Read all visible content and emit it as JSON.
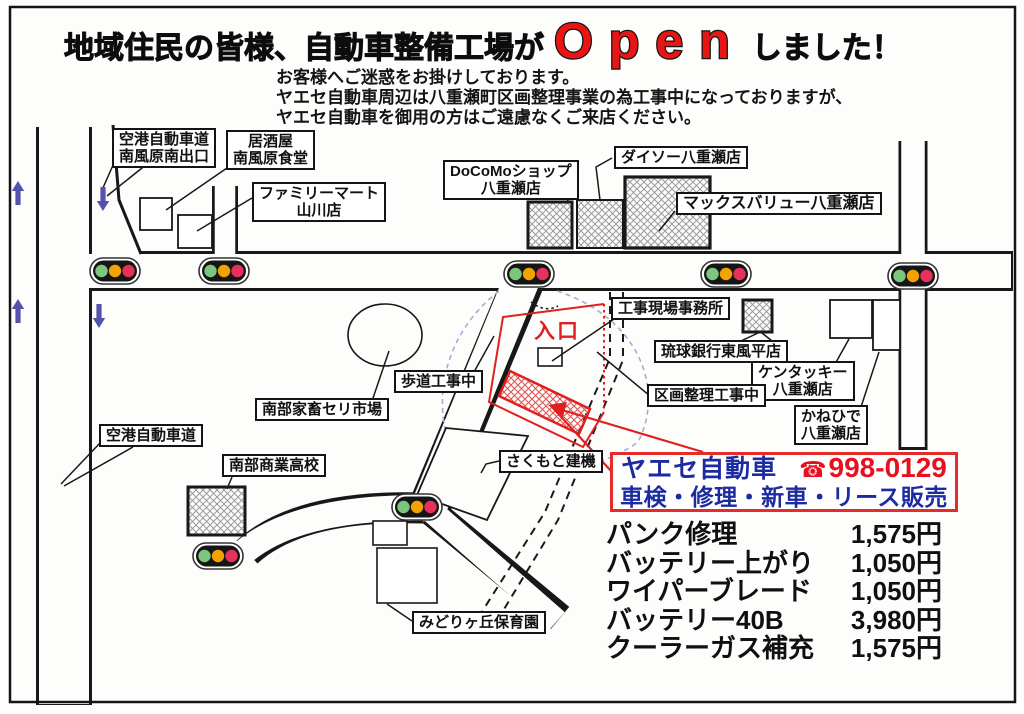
{
  "title": {
    "prefix": "地域住民の皆様、自動車整備工場が",
    "open_word": "Open",
    "suffix": "しました！"
  },
  "notice": "お客様へご迷惑をお掛けしております。\nヤエセ自動車周辺は八重瀬町区画整理事業の為工事中になっておりますが、\nヤエセ自動車を御用の方はご遠慮なくご来店ください。",
  "map": {
    "entrance_label": "入口",
    "labels": [
      {
        "id": "airport-exit",
        "text": "空港自動車道\n南風原南出口"
      },
      {
        "id": "izakaya",
        "text": "居酒屋\n南風原食堂"
      },
      {
        "id": "familymart",
        "text": "ファミリーマート\n山川店"
      },
      {
        "id": "docomo",
        "text": "DoCoMoショップ\n八重瀬店"
      },
      {
        "id": "daiso",
        "text": "ダイソー八重瀬店"
      },
      {
        "id": "maxvalu",
        "text": "マックスバリュー八重瀬店"
      },
      {
        "id": "site-office",
        "text": "工事現場事務所"
      },
      {
        "id": "ryukyu-bank",
        "text": "琉球銀行東風平店"
      },
      {
        "id": "kfc",
        "text": "ケンタッキー\n八重瀬店"
      },
      {
        "id": "kanehide",
        "text": "かねひで\n八重瀬店"
      },
      {
        "id": "kukaku-kouji",
        "text": "区画整理工事中"
      },
      {
        "id": "hodou-kouji",
        "text": "歩道工事中"
      },
      {
        "id": "cattle-market",
        "text": "南部家畜セリ市場"
      },
      {
        "id": "airport-road",
        "text": "空港自動車道"
      },
      {
        "id": "nanbu-school",
        "text": "南部商業高校"
      },
      {
        "id": "sakumoto",
        "text": "さくもと建機"
      },
      {
        "id": "midorigaoka",
        "text": "みどりヶ丘保育園"
      }
    ]
  },
  "info_box": {
    "shop_name": "ヤエセ自動車",
    "phone_icon": "☎",
    "phone": "998-0129",
    "services": "車検・修理・新車・リース販売"
  },
  "price_list": [
    {
      "item": "パンク修理",
      "price": "1,575円"
    },
    {
      "item": "バッテリー上がり",
      "price": "1,050円"
    },
    {
      "item": "ワイパーブレード",
      "price": "1,050円"
    },
    {
      "item": "バッテリー40B",
      "price": "3,980円"
    },
    {
      "item": "クーラーガス補充",
      "price": "1,575円"
    }
  ],
  "colors": {
    "accent_red": "#e81515",
    "brand_blue": "#1d2ba0",
    "traffic_green": "#7bc77f",
    "traffic_amber": "#f2a300",
    "traffic_red": "#e6315c",
    "direction_arrow_blue": "#5353ae",
    "construction_dash_blue": "#9fb0d8"
  }
}
